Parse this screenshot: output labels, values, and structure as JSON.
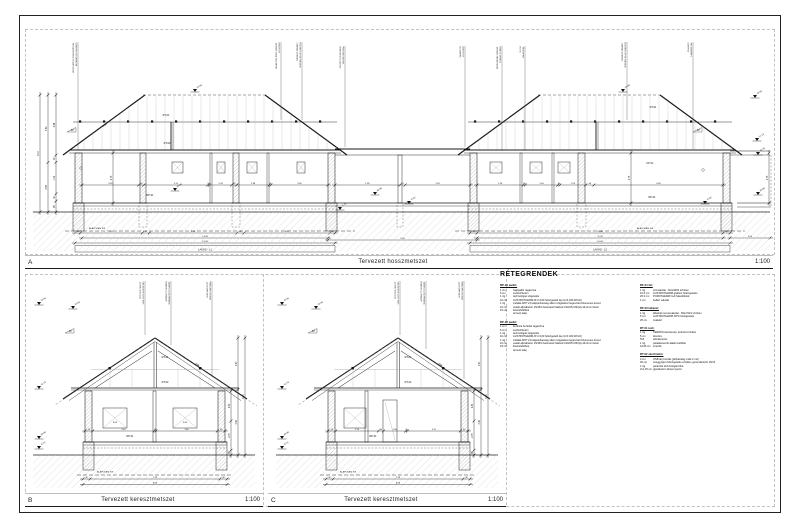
{
  "sheet": {
    "bg": "#ffffff",
    "line_color": "#1a1a1a",
    "hatch_color": "#cfcfcf"
  },
  "panels": {
    "a": {
      "letter": "A",
      "title": "Tervezett hosszmetszet",
      "scale": "1:100"
    },
    "b": {
      "letter": "B",
      "title": "Tervezett keresztmetszet",
      "scale": "1:100"
    },
    "c": {
      "letter": "C",
      "title": "Tervezett keresztmetszet",
      "scale": "1:100"
    }
  },
  "legend": {
    "title": "RÉTEGRENDEK",
    "columns": [
      {
        "blocks": [
          {
            "heading": "RP-01 padló:",
            "rows": [
              [
                "1 cm",
                "hajópadló ragasztva"
              ],
              [
                "6 cm",
                "esztrichbeton"
              ],
              [
                "1 rtg",
                "technológiai szigetelés"
              ],
              [
                "10 cm",
                "AUSTROTHERM AT-N 100 hőszigetelő lap (λ=0,040 W/mK)"
              ],
              [
                "1 rtg",
                "Cefalát APP V4 talajnedvesség elleni szigetelés hegesztett bitumenes lemez"
              ],
              [
                "10 cm",
                "vasalt aljzatbeton 15/15/4 betonacél hálóval C20/25-X0b(H)-16-2mm beton"
              ],
              [
                "15 cm",
                "kavicsfeltöltés"
              ],
              [
                "",
                "termett talaj"
              ]
            ]
          },
          {
            "heading": "RP-02 padló:",
            "rows": [
              [
                "1 cm",
                "kerámia burkolat ragasztva"
              ],
              [
                "6 cm",
                "esztrichbeton"
              ],
              [
                "1 rtg",
                "technológiai szigetelés"
              ],
              [
                "10 cm",
                "AUSTROTHERM AT-N 100 hőszigetelő lap (λ=0,040 W/mK)"
              ],
              [
                "1 rtg",
                "Cefalát APP V4 talajnedvesség elleni szigetelés hegesztett bitumenes lemez"
              ],
              [
                "10 cm",
                "vasalt aljzatbeton 15/15/4 betonacél hálóval C20/25-X0b(H)-16-2mm beton"
              ],
              [
                "15 cm",
                "kavicsfeltöltés"
              ],
              [
                "",
                "termett talaj"
              ]
            ]
          }
        ]
      },
      {
        "blocks": [
          {
            "heading": "RF-01 fal:",
            "rows": [
              [
                "1 rtg",
                "színvakolat - RAL9003 színben"
              ],
              [
                "10.5 cm",
                "AUSTROTHERM grafitos hőszigetelés"
              ],
              [
                "26.3 cm",
                "POROTHERM N+F falazóblokk"
              ],
              [
                "1 cm",
                "beltéri vakolat"
              ]
            ]
          },
          {
            "heading": "RF-02 lábazat:",
            "rows": [
              [
                "1 rtg",
                "lábazati nemesvakolat - RAL7024 színben"
              ],
              [
                "5 cm",
                "AUSTROTHERM XPS hőszigetelés"
              ],
              [
                "25 cm",
                "zsalukő"
              ]
            ]
          },
          {
            "heading": "RT-01 tető:",
            "rows": [
              [
                "1 rtg",
                "TERRÁN tetőcserép, antracit színben"
              ],
              [
                "5 cm",
                "lécezés"
              ],
              [
                "5x5",
                "ellenlécezés"
              ],
              [
                "1 rtg",
                "páraáteresztő alátét tetőfólia"
              ],
              [
                "10/15 cm",
                "szarufa"
              ]
            ]
          },
          {
            "heading": "RT-02 zárófödém:",
            "rows": [
              [
                "2 cm",
                "OSB lap borítás (járhatóság miatt 2 m2)"
              ],
              [
                "30 cm",
                "üveggyapot hőszigetelés a födém gerendái közt 15/10"
              ],
              [
                "1 rtg",
                "párazáró technológiai fólia"
              ],
              [
                "2x1,25 cm",
                "gipszkarton álmennyezet"
              ]
            ]
          }
        ]
      }
    ]
  },
  "long_section": {
    "house1": {
      "label": "LAKÁS - L1",
      "inner_dims": [
        "3.28",
        "30",
        "3.70",
        "10",
        "1.28",
        "30",
        "1.88",
        "10",
        "3.30"
      ],
      "bottom_dims": [
        "30",
        "3.52",
        "40",
        "4.98",
        "40",
        "4.87",
        "30"
      ],
      "total_inner": "14.08",
      "total_outer": "15.08"
    },
    "house2": {
      "label": "LAKÁS - L2",
      "inner_dims": [
        "2.28",
        "10",
        "1.60",
        "10",
        "1.28",
        "40",
        "6.36"
      ],
      "bottom_dims": [
        "30",
        "10.48",
        "30"
      ],
      "total_inner": "11.08",
      "total_outer": "15.08"
    },
    "middle": {
      "dims": [
        "1.85",
        "15",
        "1.85"
      ],
      "total": "9.00"
    },
    "right_ext": "3.00",
    "left_vdims": [
      [
        "6.10"
      ],
      [
        "3.52",
        "2.58"
      ],
      [
        "2.48",
        "30",
        "1.30",
        "30",
        "45"
      ]
    ],
    "room_height": "2.75",
    "slope_label": "30°",
    "slope_len": "5.34",
    "foundation_label": "ALAPOZÁSI SÍK",
    "refs": {
      "rt01": "RT-01",
      "rt02": "RT-02",
      "rp01": "RP-01",
      "kp01": "KP-01"
    },
    "elevations": [
      "+5.60",
      "+5.60",
      "+5.60",
      "+1.13",
      "+2.75",
      "±0.00",
      "±0.00",
      "-0.43",
      "-1.43",
      "-0.45",
      "±0.00"
    ],
    "callouts": [
      [
        "BEJÁRATI NYÍLÁSZÁRÓ",
        "HŐSZIGETELŐ ÜVEGEZÉSSEL"
      ],
      [
        "KOSZORÚ",
        "VASBETON TERV SZERINT"
      ],
      [
        "TERVEN JELÖLT HELYEN",
        "SZERELT KÉMÉNY"
      ],
      [
        "SZEGÉLYDESZKA",
        "FESTETT KIVITELBEN"
      ],
      [
        "KOSZORÚ",
        "VASBETON"
      ],
      [
        "TERASZ FÖDÉM",
        "RÉTEGREND SZERINT"
      ],
      [
        "VÁLASZFAL",
        "10 CM"
      ],
      [
        "TERVEN JELÖLT HELYEN",
        "SZERELT KÉMÉNY"
      ],
      [
        "LÁBAZATI FAL",
        "ZSALUKŐ"
      ]
    ]
  },
  "cross_b": {
    "win_dims": [
      "45",
      "3.60",
      "10",
      "3.60",
      "45"
    ],
    "win_label": "3.60",
    "bottom_dims": [
      "40",
      "7.28",
      "40"
    ],
    "total": "8.08",
    "right_vdims": [
      [
        "2.80",
        "2.75",
        "45"
      ],
      [
        "2.67",
        "3.40"
      ],
      [
        "6.10"
      ]
    ],
    "elevations": [
      "+5.66",
      "+5.60",
      "+2.73",
      "±0.00",
      "-0.73"
    ],
    "slope_label": "30°",
    "slope_len": "5.58",
    "foundation_label": "ALAPOZÁSI SÍK",
    "refs": {
      "rt01": "RT-01",
      "rt02": "RT-02",
      "rp01": "RP-01"
    },
    "callouts": [
      [
        "SZELLŐZŐ KIVEZETÉS",
        "TETŐSÍK FELETT"
      ],
      [
        "TERRÁN TETŐCSERÉP",
        "ANTRACIT SZÍNBEN"
      ],
      [
        "ERESZCSATORNA",
        "HORGANYZOTT"
      ]
    ]
  },
  "cross_c": {
    "win_dims": [
      "45",
      "2.50",
      "30",
      "1.30",
      "10",
      "3.10",
      "45"
    ],
    "win_label": "3.60",
    "bottom_dims": [
      "40",
      "7.28",
      "40"
    ],
    "total": "8.08",
    "right_vdims": [
      [
        "2.80",
        "2.75",
        "45"
      ],
      [
        "2.67",
        "3.40"
      ],
      [
        "6.10"
      ]
    ],
    "elevations": [
      "+5.66",
      "+5.60",
      "+2.73",
      "±0.00",
      "-0.73"
    ],
    "slope_label": "30°",
    "slope_len": "5.58",
    "foundation_label": "ALAPOZÁSI SÍK",
    "refs": {
      "rt01": "RT-01",
      "rt02": "RT-02",
      "rp01": "RP-01"
    },
    "callouts": [
      [
        "SZELLŐZŐ KIVEZETÉS",
        "TETŐSÍK FELETT"
      ],
      [
        "TERRÁN TETŐCSERÉP",
        "ANTRACIT SZÍNBEN"
      ],
      [
        "ERESZCSATORNA",
        "HORGANYZOTT"
      ]
    ]
  }
}
